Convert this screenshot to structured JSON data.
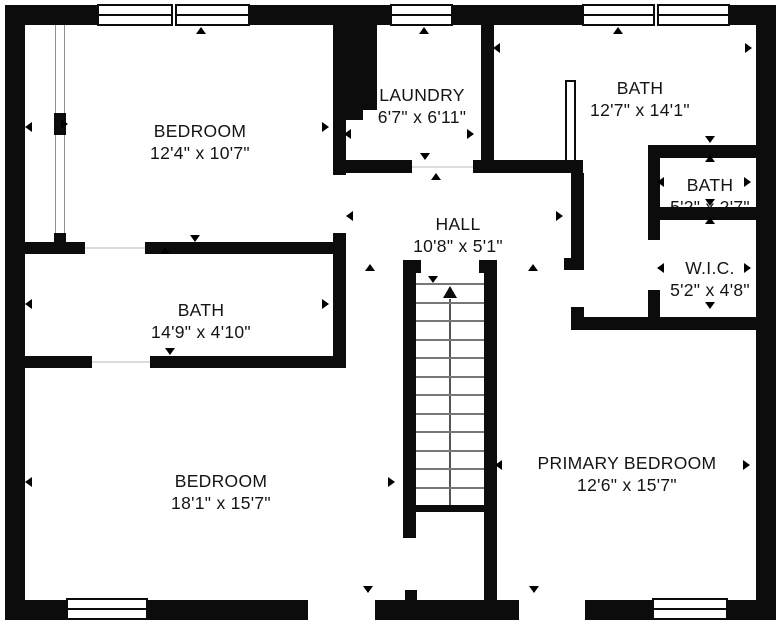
{
  "colors": {
    "wall": "#0c0c0c",
    "background": "#ffffff",
    "tread_line": "#777777",
    "text": "#141414"
  },
  "rooms": [
    {
      "id": "bedroom-1",
      "name": "BEDROOM",
      "dims": "12'4\" x 10'7\""
    },
    {
      "id": "laundry",
      "name": "LAUNDRY",
      "dims": "6'7\" x 6'11\""
    },
    {
      "id": "bath-main",
      "name": "BATH",
      "dims": "12'7\" x 14'1\""
    },
    {
      "id": "bath-small",
      "name": "BATH",
      "dims": "5'2\" x 2'7\""
    },
    {
      "id": "wic",
      "name": "W.I.C.",
      "dims": "5'2\" x 4'8\""
    },
    {
      "id": "hall",
      "name": "HALL",
      "dims": "10'8\" x 5'1\""
    },
    {
      "id": "bath-left",
      "name": "BATH",
      "dims": "14'9\" x 4'10\""
    },
    {
      "id": "bedroom-2",
      "name": "BEDROOM",
      "dims": "18'1\" x 15'7\""
    },
    {
      "id": "primary-bedroom",
      "name": "PRIMARY BEDROOM",
      "dims": "12'6\" x 15'7\""
    }
  ],
  "stairs": {
    "direction": "up",
    "treads": 12
  },
  "markers": [
    {
      "x": 201,
      "y": 31,
      "dir": "up"
    },
    {
      "x": 424,
      "y": 31,
      "dir": "up"
    },
    {
      "x": 618,
      "y": 31,
      "dir": "up"
    },
    {
      "x": 165,
      "y": 251,
      "dir": "up"
    },
    {
      "x": 436,
      "y": 177,
      "dir": "up"
    },
    {
      "x": 370,
      "y": 268,
      "dir": "up"
    },
    {
      "x": 533,
      "y": 268,
      "dir": "up"
    },
    {
      "x": 710,
      "y": 159,
      "dir": "up"
    },
    {
      "x": 710,
      "y": 221,
      "dir": "up"
    },
    {
      "x": 195,
      "y": 239,
      "dir": "down"
    },
    {
      "x": 425,
      "y": 157,
      "dir": "down"
    },
    {
      "x": 710,
      "y": 140,
      "dir": "down"
    },
    {
      "x": 710,
      "y": 203,
      "dir": "down"
    },
    {
      "x": 710,
      "y": 306,
      "dir": "down"
    },
    {
      "x": 170,
      "y": 352,
      "dir": "down"
    },
    {
      "x": 433,
      "y": 280,
      "dir": "down"
    },
    {
      "x": 368,
      "y": 590,
      "dir": "down"
    },
    {
      "x": 534,
      "y": 590,
      "dir": "down"
    },
    {
      "x": 30,
      "y": 126,
      "dir": "left"
    },
    {
      "x": 349,
      "y": 133,
      "dir": "left"
    },
    {
      "x": 498,
      "y": 47,
      "dir": "left"
    },
    {
      "x": 30,
      "y": 303,
      "dir": "left"
    },
    {
      "x": 351,
      "y": 215,
      "dir": "left"
    },
    {
      "x": 662,
      "y": 181,
      "dir": "left"
    },
    {
      "x": 662,
      "y": 267,
      "dir": "left"
    },
    {
      "x": 30,
      "y": 481,
      "dir": "left"
    },
    {
      "x": 500,
      "y": 464,
      "dir": "left"
    },
    {
      "x": 327,
      "y": 126,
      "dir": "right"
    },
    {
      "x": 472,
      "y": 133,
      "dir": "right"
    },
    {
      "x": 750,
      "y": 47,
      "dir": "right"
    },
    {
      "x": 327,
      "y": 303,
      "dir": "right"
    },
    {
      "x": 561,
      "y": 215,
      "dir": "right"
    },
    {
      "x": 749,
      "y": 181,
      "dir": "right"
    },
    {
      "x": 749,
      "y": 267,
      "dir": "right"
    },
    {
      "x": 393,
      "y": 481,
      "dir": "right"
    },
    {
      "x": 748,
      "y": 464,
      "dir": "right"
    },
    {
      "x": 66,
      "y": 123,
      "dir": "right"
    }
  ]
}
